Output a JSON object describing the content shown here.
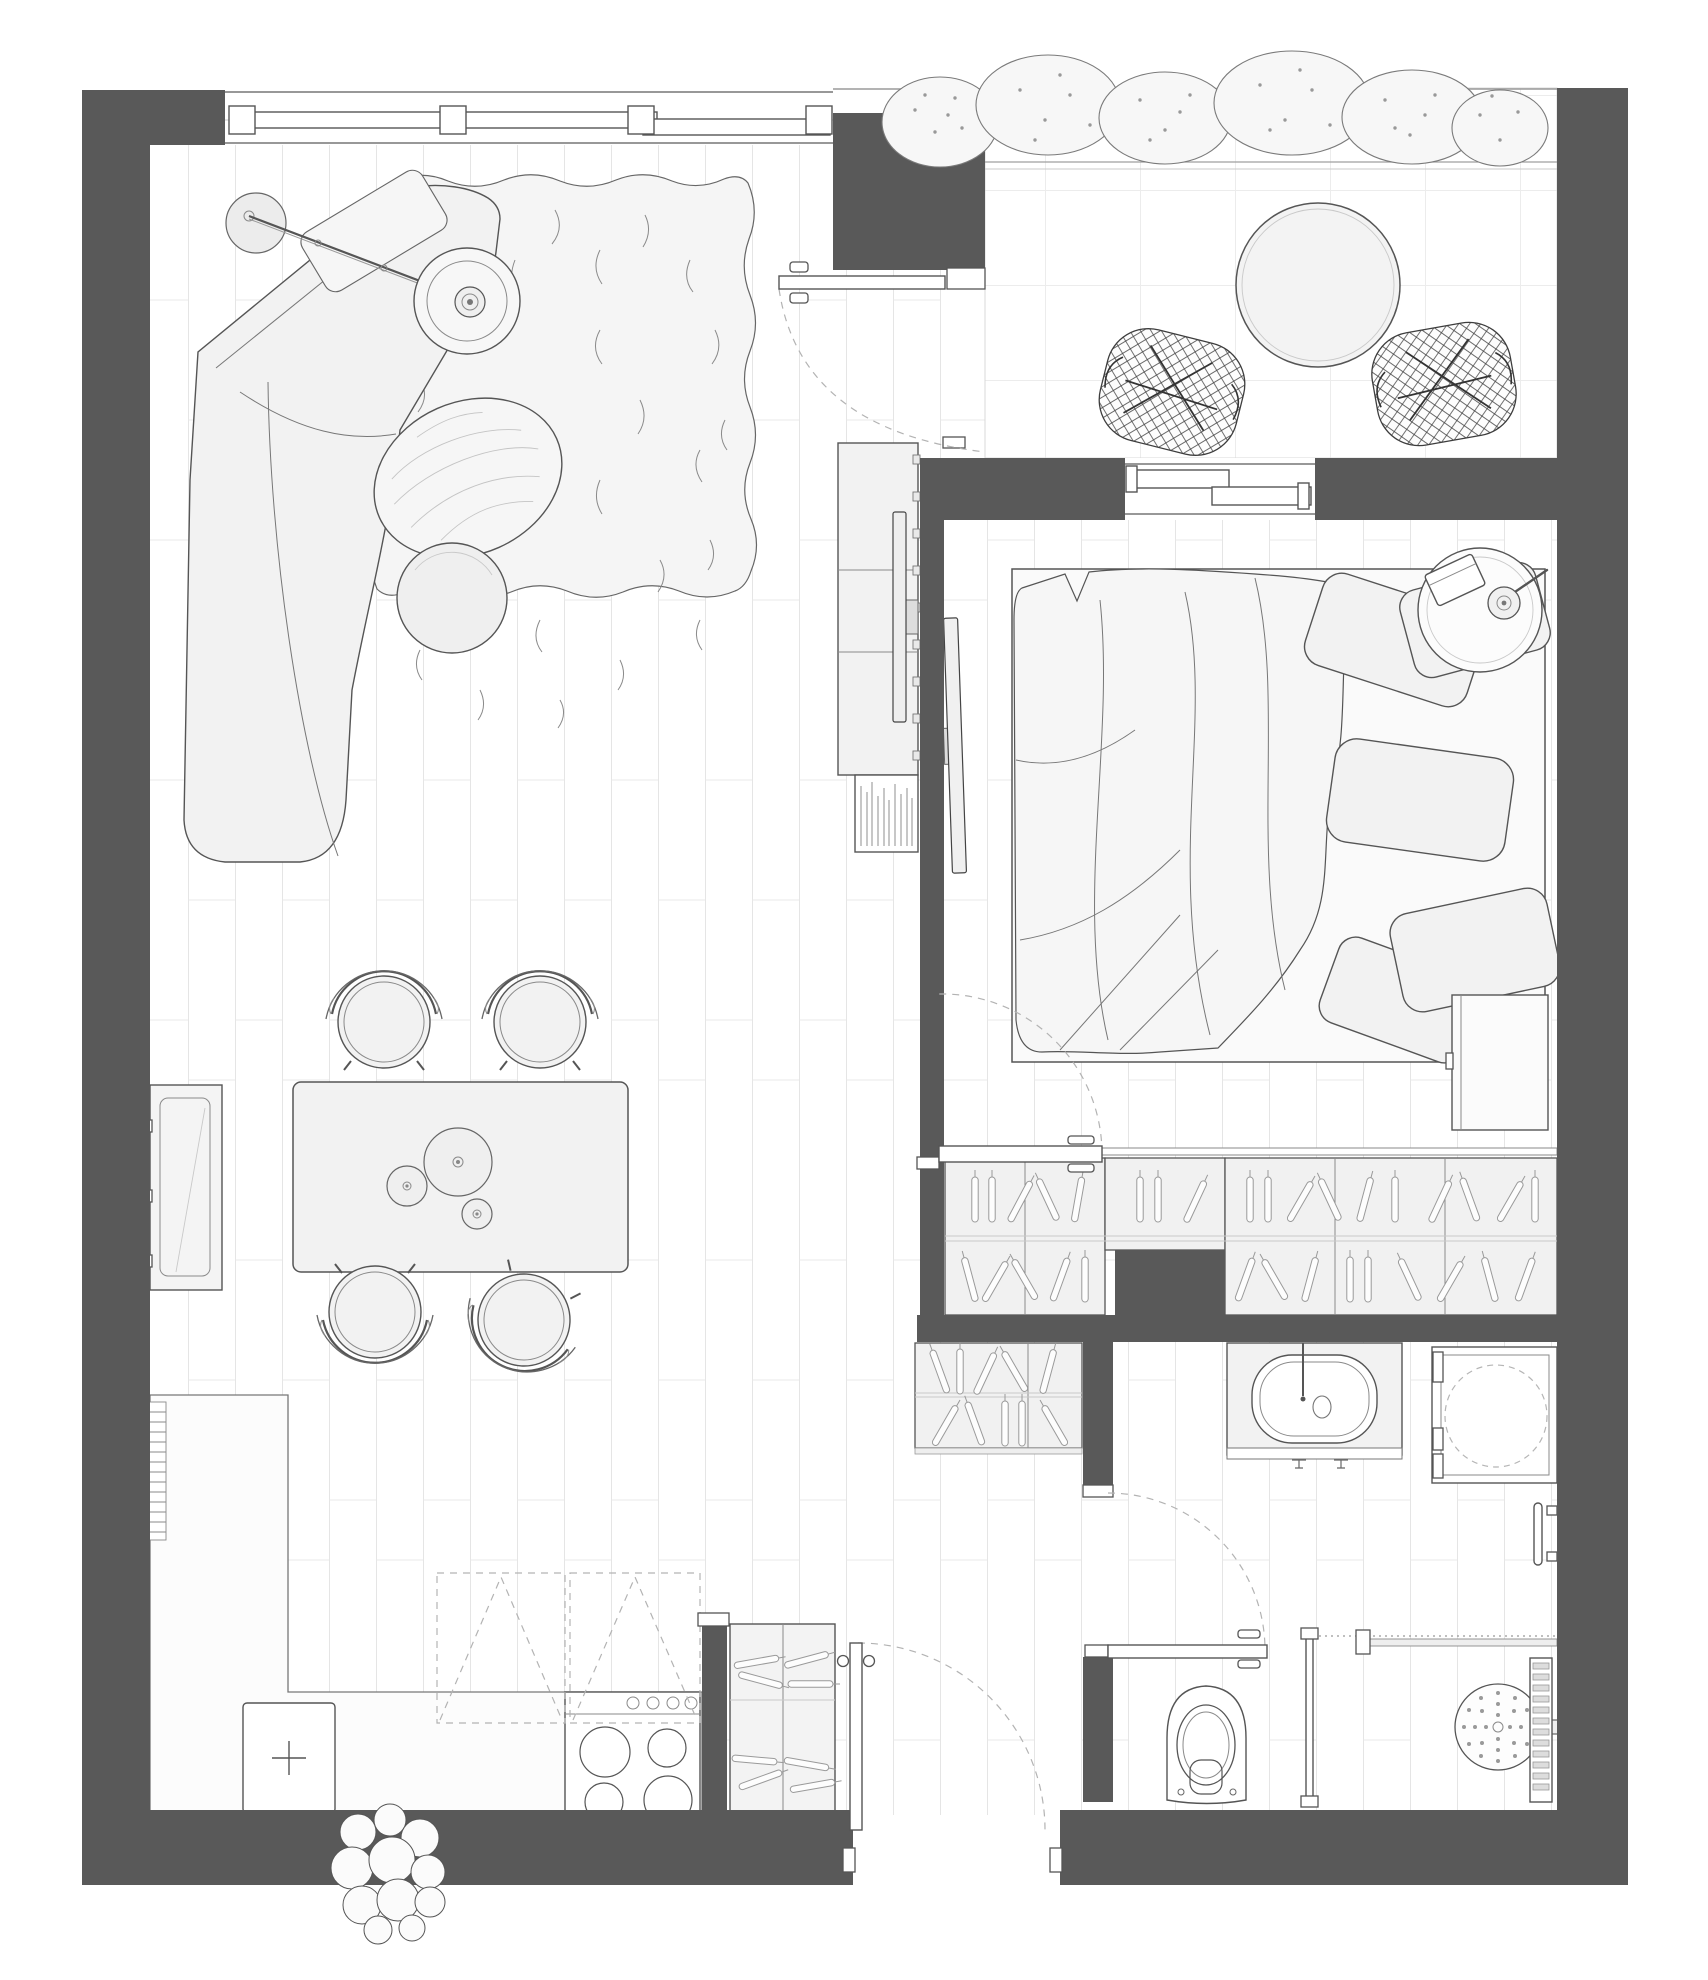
{
  "meta": {
    "title": "Studio apartment floor plan, top-down architectural drawing",
    "view": "top-down",
    "width_px": 1708,
    "height_px": 1980
  },
  "colors": {
    "wall": "#595959",
    "floor": "#ffffff",
    "plank_line": "#e5e5e5",
    "tile_line": "#ececec",
    "rug": "#f5f5f5",
    "furniture_fill": "#f2f2f2",
    "furniture_stroke": "#555555",
    "detail_stroke": "#8a8a8a",
    "dash_stroke": "#b3b3b3"
  },
  "rooms": [
    {
      "id": "living-room",
      "furniture": [
        {
          "name": "corner-sofa",
          "qty": 1
        },
        {
          "name": "shag-rug",
          "qty": 1
        },
        {
          "name": "arc-floor-lamp",
          "qty": 1
        },
        {
          "name": "oval-wood-coffee-table",
          "qty": 1
        },
        {
          "name": "round-side-table",
          "qty": 1
        },
        {
          "name": "tv-sideboard",
          "qty": 1
        },
        {
          "name": "tv",
          "qty": 1
        },
        {
          "name": "book-shelf",
          "qty": 1
        }
      ]
    },
    {
      "id": "dining-area",
      "furniture": [
        {
          "name": "dining-table",
          "qty": 1
        },
        {
          "name": "dining-chair",
          "qty": 4
        },
        {
          "name": "serving-plate",
          "qty": 3
        },
        {
          "name": "wall-heater-panel",
          "qty": 1
        }
      ]
    },
    {
      "id": "kitchen",
      "furniture": [
        {
          "name": "l-shaped-counter",
          "qty": 1
        },
        {
          "name": "kitchen-sink",
          "qty": 1
        },
        {
          "name": "cooktop",
          "qty": 1,
          "burners": 4
        },
        {
          "name": "overhead-cabinets-dashed",
          "qty": 2
        },
        {
          "name": "radiator",
          "qty": 1
        },
        {
          "name": "potted-plant",
          "qty": 1
        },
        {
          "name": "entry-closet",
          "qty": 1
        }
      ]
    },
    {
      "id": "balcony",
      "furniture": [
        {
          "name": "round-bistro-table",
          "qty": 1
        },
        {
          "name": "wire-mesh-chair",
          "qty": 2
        },
        {
          "name": "shrub-planting",
          "qty": 6
        }
      ]
    },
    {
      "id": "bedroom",
      "furniture": [
        {
          "name": "double-bed",
          "qty": 1
        },
        {
          "name": "duvet",
          "qty": 1
        },
        {
          "name": "pillow",
          "qty": 5
        },
        {
          "name": "round-bedside-table",
          "qty": 1
        },
        {
          "name": "reading-lamp",
          "qty": 1
        },
        {
          "name": "book",
          "qty": 1
        },
        {
          "name": "dresser",
          "qty": 1
        },
        {
          "name": "tv",
          "qty": 1
        }
      ]
    },
    {
      "id": "wardrobe-corridor",
      "furniture": [
        {
          "name": "wardrobe-section",
          "qty": 5
        },
        {
          "name": "hall-wardrobe",
          "qty": 1
        }
      ]
    },
    {
      "id": "bathroom",
      "furniture": [
        {
          "name": "vanity-basin",
          "qty": 1
        },
        {
          "name": "washing-machine",
          "qty": 1
        },
        {
          "name": "towel-rail",
          "qty": 1
        },
        {
          "name": "shower-head",
          "qty": 1
        },
        {
          "name": "drain-grate",
          "qty": 1
        },
        {
          "name": "glass-partition",
          "qty": 1
        }
      ]
    },
    {
      "id": "wc",
      "furniture": [
        {
          "name": "toilet",
          "qty": 1
        }
      ]
    }
  ],
  "openings": {
    "windows": [
      "living-room-window",
      "bedroom-window"
    ],
    "doors": [
      "balcony-door",
      "bedroom-door",
      "bathroom-door",
      "entry-door"
    ]
  },
  "counts": {
    "dining_chairs": 4,
    "balcony_chairs": 2,
    "cooktop_burners": 4,
    "pillows": 5,
    "wardrobe_sections": 5,
    "doors": 4,
    "windows": 2
  }
}
